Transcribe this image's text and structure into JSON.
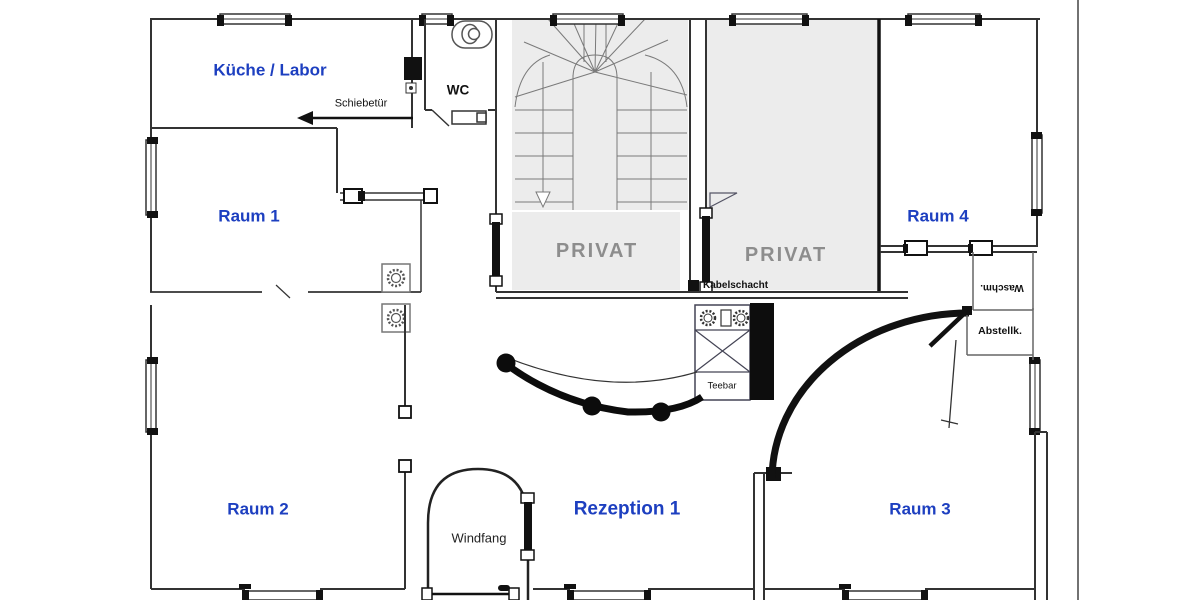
{
  "rooms": {
    "kueche_labor": {
      "label": "Küche / Labor"
    },
    "wc": {
      "label": "WC"
    },
    "raum1": {
      "label": "Raum 1"
    },
    "raum2": {
      "label": "Raum 2"
    },
    "raum3": {
      "label": "Raum 3"
    },
    "raum4": {
      "label": "Raum 4"
    },
    "rezeption1": {
      "label": "Rezeption 1"
    },
    "windfang": {
      "label": "Windfang"
    },
    "privat_links": {
      "label": "PRIVAT"
    },
    "privat_rechts": {
      "label": "PRIVAT"
    }
  },
  "annotations": {
    "schiebetuer": {
      "label": "Schiebetür"
    },
    "kabelschacht": {
      "label": "Kabelschacht"
    },
    "teebar": {
      "label": "Teebar"
    },
    "waschmaschine": {
      "label": "Waschm."
    },
    "abstellkammer": {
      "label": "Abstellk."
    }
  },
  "colors": {
    "room_label_blue": "#1d3fc0",
    "privat_label_gray": "#8d8d8d",
    "room_fill_gray": "#ececec",
    "wall_line": "#333333",
    "feature_black": "#0d0d0d"
  }
}
